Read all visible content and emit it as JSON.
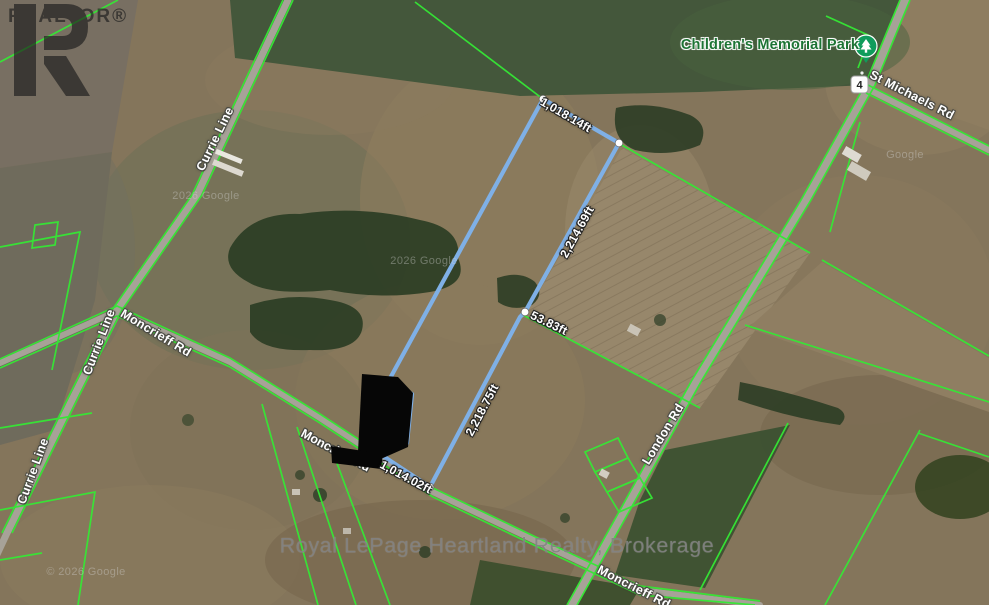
{
  "map": {
    "poi": {
      "park": "Children's Memorial Park",
      "route_shield": "4"
    },
    "roads": {
      "currie_line": "Currie Line",
      "moncrieff_rd": "Moncrieff Rd",
      "london_rd": "London Rd",
      "st_michaels_rd": "St Michaels Rd"
    },
    "parcel": {
      "side_top": "1,018.14ft",
      "side_east_upper": "2,214.69ft",
      "side_jog": "53.83ft",
      "side_east_lower": "2,218.75ft",
      "side_south": "1,014.02ft",
      "outline_color": "#7fb0e6",
      "vertex_color": "#ffffff"
    },
    "colors": {
      "boundary_green": "#35e835",
      "measurement_text": "#ffffff",
      "park_pin_green": "#109c5c"
    },
    "watermarks": {
      "realtor": "REALTOR®",
      "brokerage": "Royal LePage Heartland Realty, Brokerage",
      "imagery_full": "© 2026 Google",
      "imagery_short": "2026 Google",
      "imagery_brand": "Google"
    }
  }
}
